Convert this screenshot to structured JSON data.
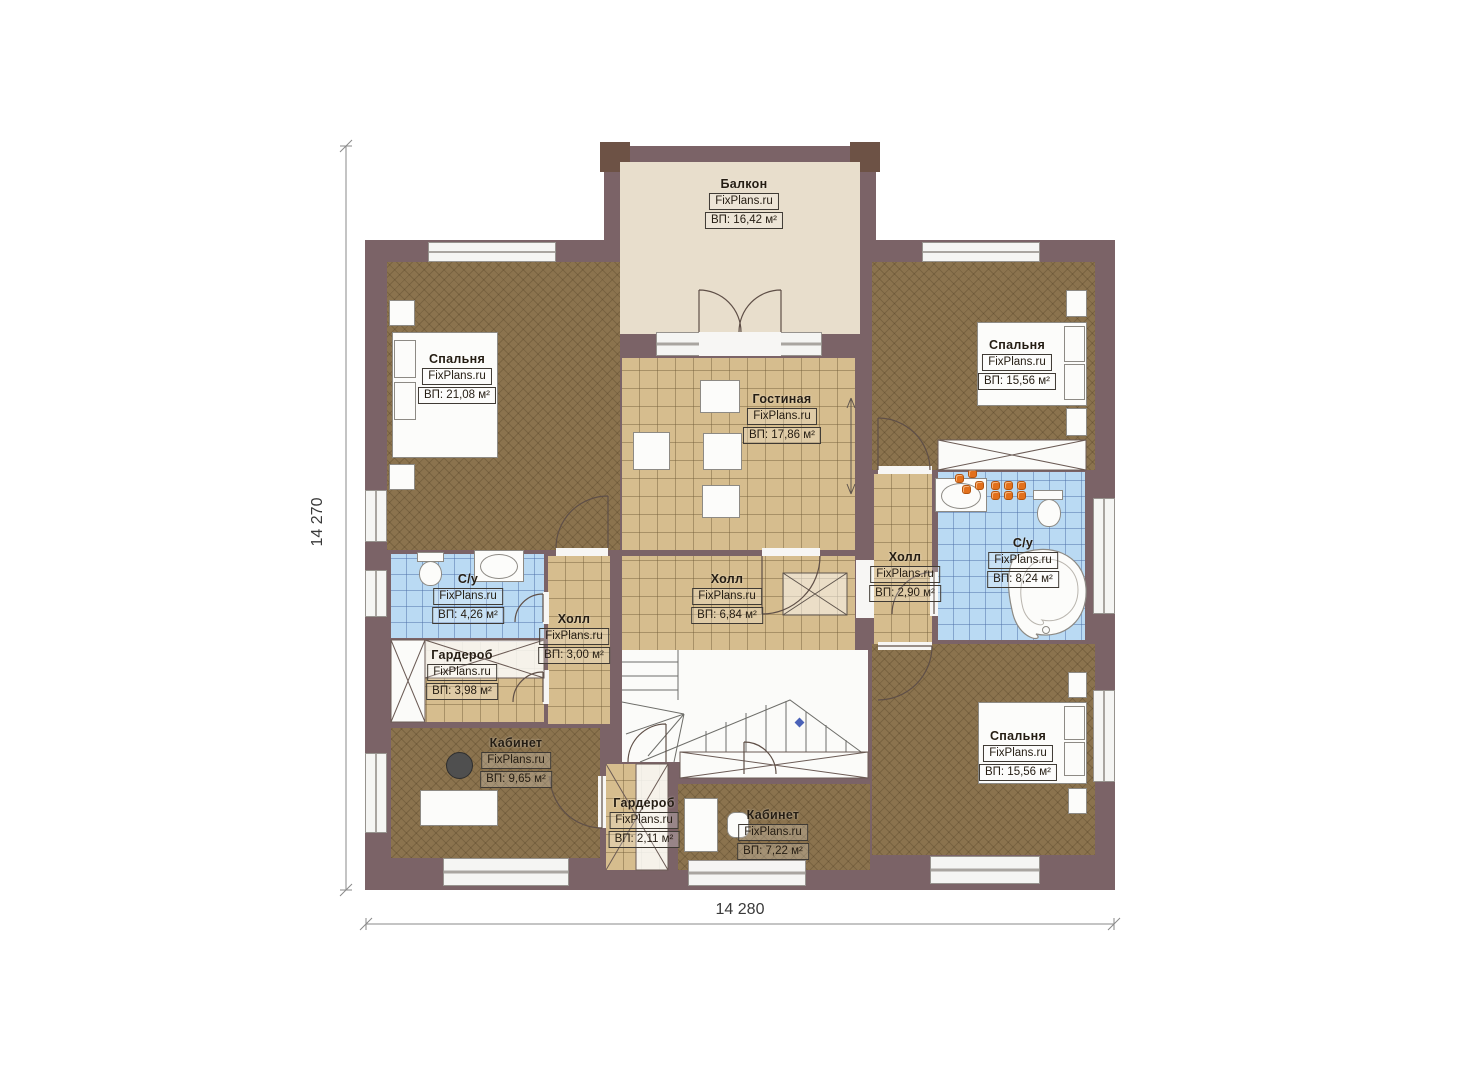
{
  "brand": "FixPlans.ru",
  "dimensions": {
    "left": "14 270",
    "bottom": "14 280"
  },
  "rooms": {
    "balcony": {
      "name": "Балкон",
      "area": "ВП: 16,42 м²"
    },
    "bedroom_tl": {
      "name": "Спальня",
      "area": "ВП: 21,08 м²"
    },
    "bedroom_tr": {
      "name": "Спальня",
      "area": "ВП: 15,56 м²"
    },
    "living": {
      "name": "Гостиная",
      "area": "ВП: 17,86 м²"
    },
    "bath_left": {
      "name": "С/у",
      "area": "ВП: 4,26 м²"
    },
    "hall_center": {
      "name": "Холл",
      "area": "ВП: 6,84 м²"
    },
    "hall_small": {
      "name": "Холл",
      "area": "ВП: 3,00 м²"
    },
    "hall_right": {
      "name": "Холл",
      "area": "ВП: 2,90 м²"
    },
    "bath_right": {
      "name": "С/у",
      "area": "ВП: 8,24 м²"
    },
    "wardrobe_left": {
      "name": "Гардероб",
      "area": "ВП: 3,98 м²"
    },
    "office_left": {
      "name": "Кабинет",
      "area": "ВП: 9,65 м²"
    },
    "wardrobe_center": {
      "name": "Гардероб",
      "area": "ВП: 2,11 м²"
    },
    "office_center": {
      "name": "Кабинет",
      "area": "ВП: 7,22 м²"
    },
    "bedroom_br": {
      "name": "Спальня",
      "area": "ВП: 15,56 м²"
    }
  },
  "colors": {
    "wall": "#7b6367",
    "wall_pillar": "#6d5245",
    "wood_floor": "#8b734e",
    "tile_floor": "#d6bd8e",
    "bath_floor": "#badaf3",
    "balcony_floor": "#e8decc",
    "fixture_orange": "#e2701c",
    "stair_marker_blue": "#4a62b8"
  }
}
